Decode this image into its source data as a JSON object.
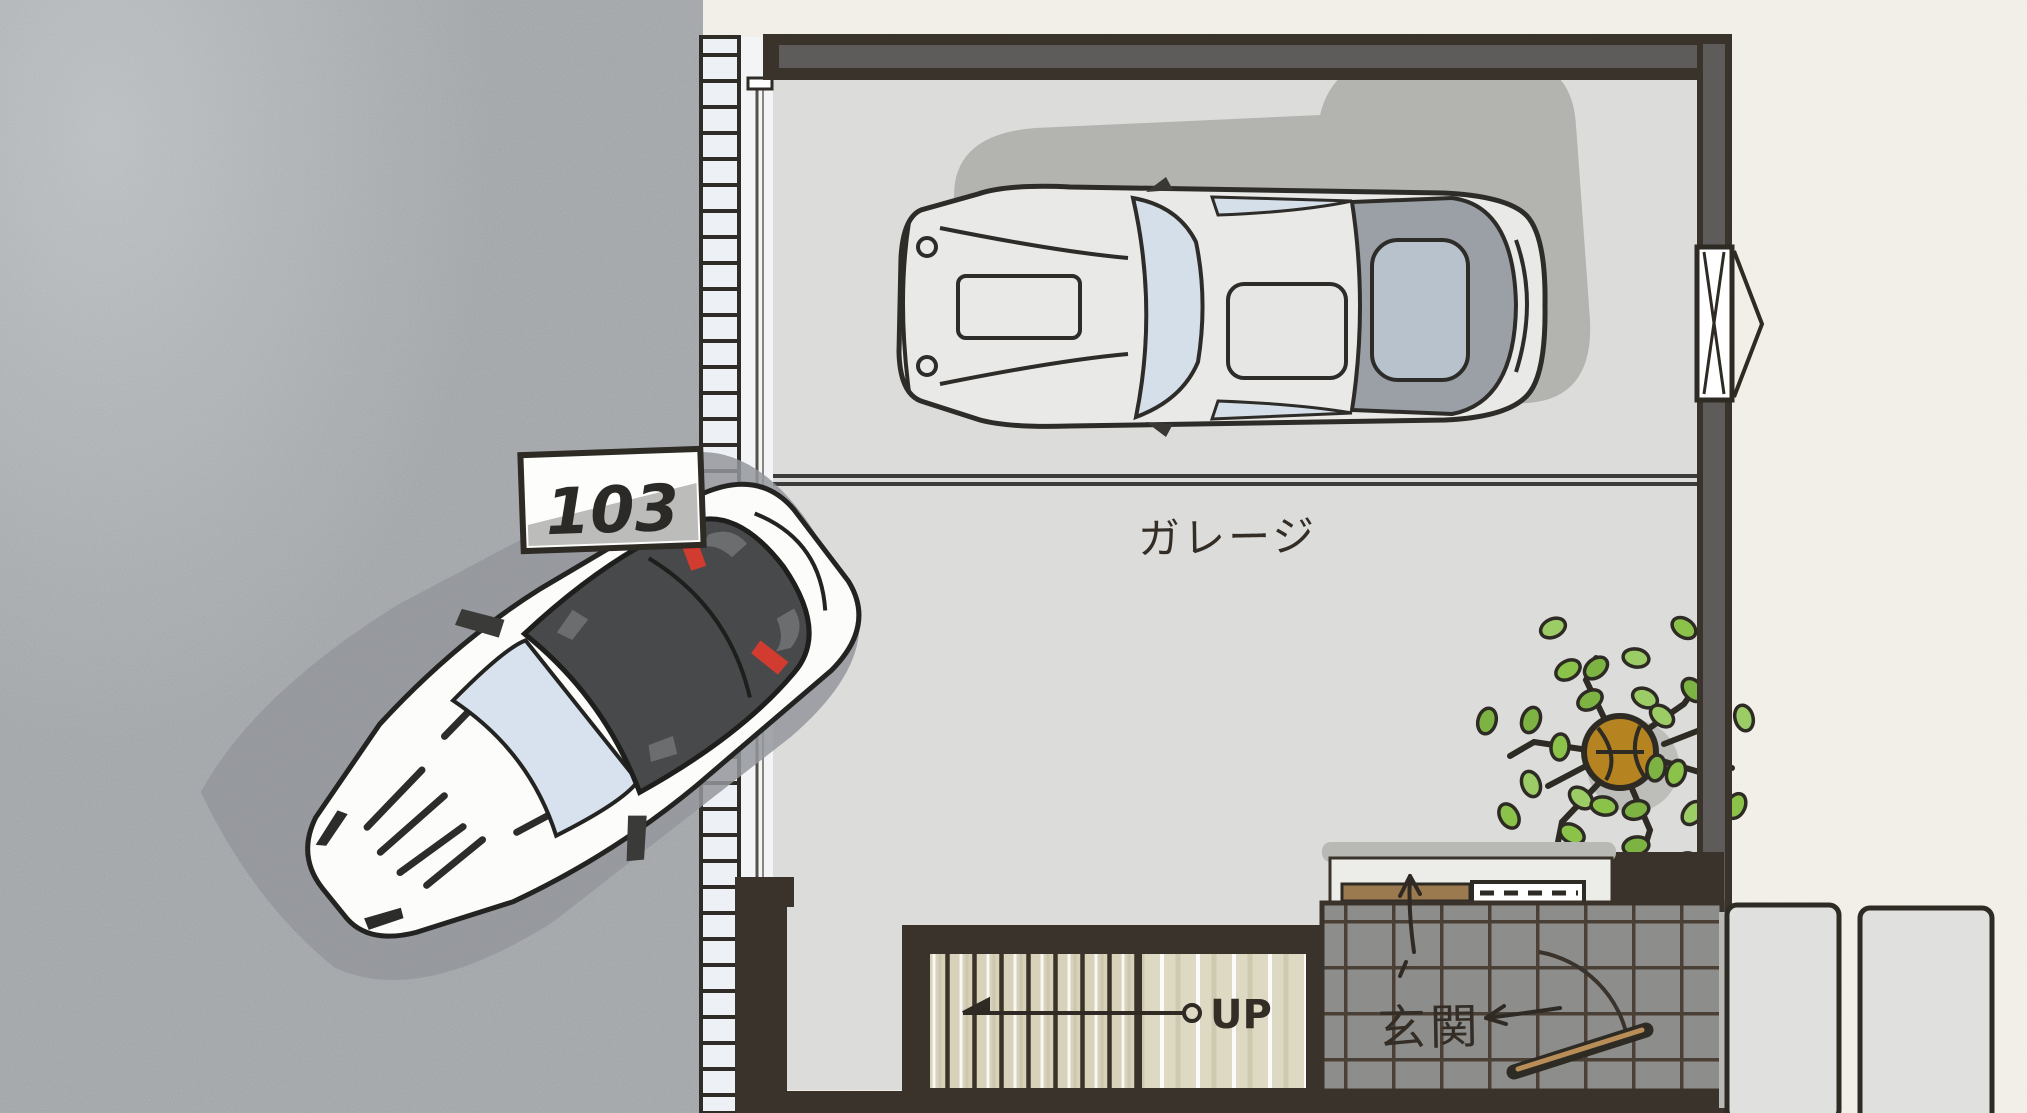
{
  "scene": {
    "unit_number": "103",
    "labels": {
      "garage": "ガレージ",
      "entrance": "玄関",
      "stairs_direction": "UP"
    },
    "colors": {
      "driveway_asphalt": "#9da0a4",
      "garage_floor": "#dcddda",
      "exterior_ground": "#f3f1ea",
      "wall_outline": "#3a332b",
      "wall_fill": "#5d5c5a",
      "shutter_slats": "#edf1f6",
      "stair_tread": "#d8d2ba",
      "stair_landing": "#ded9c3",
      "entrance_tile": "#8d8d8b",
      "stepping_stone": "#e0e1de",
      "tree_leaf_green": "#8bc34a",
      "tree_trunk_brown": "#b5831f",
      "white_car_body": "#fcfcfb",
      "white_car_canopy": "#47494b",
      "brake_light_red": "#d23b2f",
      "classic_car_body": "#e9e9e7",
      "glass_blue": "#d5dfe9",
      "shadow_gray": "#b3b3b0"
    },
    "elements": [
      "driveway-asphalt",
      "garage-shutter-door",
      "unit-number-sign",
      "white-sports-car",
      "classic-car",
      "parking-divider-line",
      "garage-floor",
      "potted-tree",
      "window-casement",
      "stairs-up",
      "stairs-landing",
      "entrance-tiled-floor",
      "entrance-door",
      "shoe-cabinet-threshold",
      "stepping-stones",
      "exterior-ground"
    ]
  }
}
